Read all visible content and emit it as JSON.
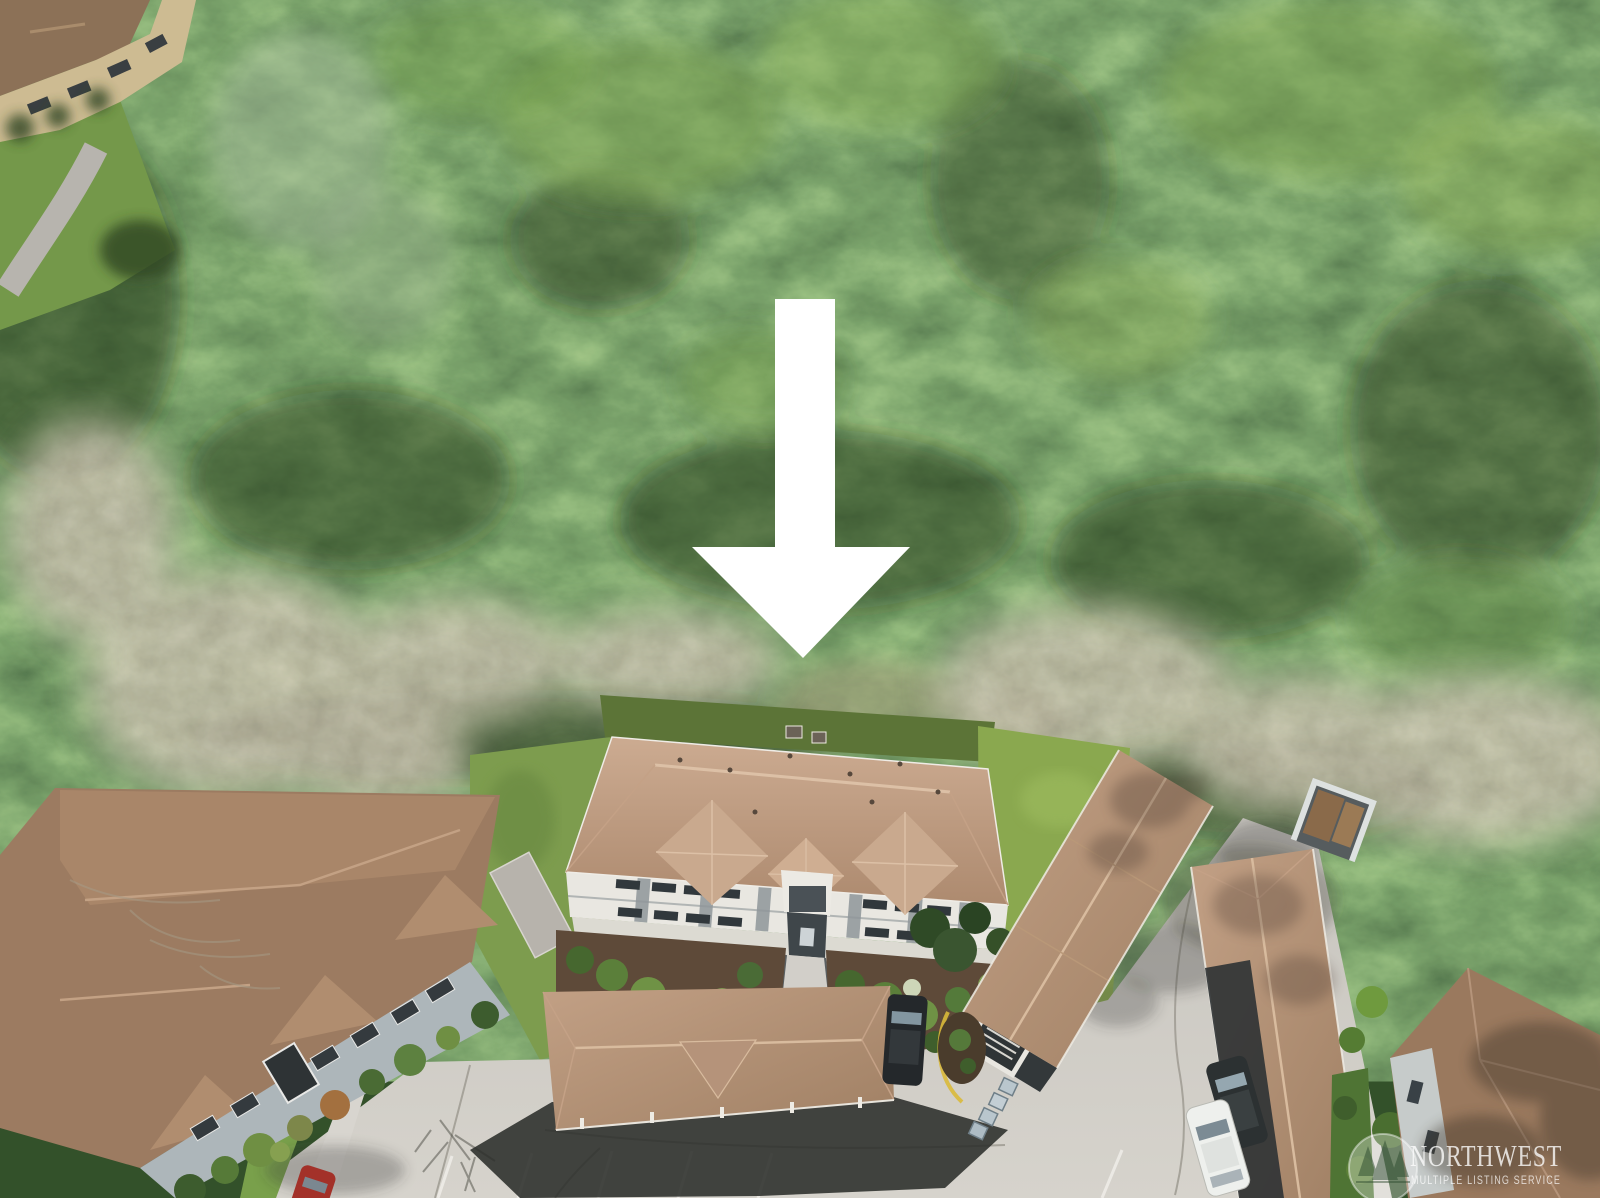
{
  "image": {
    "kind": "aerial-drone-photo",
    "subject": "three-story condominium building in evergreen forest with carports and parking"
  },
  "marker": {
    "name": "down-arrow",
    "color": "#ffffff"
  },
  "watermark": {
    "line1": "NORTHWEST",
    "line2": "MULTIPLE LISTING SERVICE",
    "logo": "nwmls-tree-circle-logo",
    "color": "#ffffff"
  },
  "scene_elements": [
    "evergreen-forest",
    "bare-deciduous-band",
    "top-left-condo-building",
    "curved-road",
    "left-condo-complex",
    "main-condo-building",
    "entry-walkway",
    "landscaped-beds",
    "center-carport",
    "carport-a",
    "carport-b",
    "driveway",
    "parking-lot",
    "dumpster-enclosure",
    "recycling-bins",
    "black-suv",
    "dark-suv",
    "white-car",
    "red-car",
    "bottom-right-building",
    "down-arrow-marker",
    "nwmls-watermark"
  ],
  "palette": {
    "forest_dark": "#23391d",
    "forest_mid": "#3f6130",
    "forest_light": "#7ca24e",
    "bare_trees": "#9a9080",
    "roof_tan": "#c0a189",
    "roof_brown": "#9c7b61",
    "wall_white": "#e9e7e1",
    "wall_gray": "#adb6ba",
    "concrete": "#cdcac4",
    "lawn": "#7fa04c",
    "shadow": "#2b2d2a",
    "arrow": "#ffffff",
    "car_red": "#a33129",
    "car_white": "#eef0ed",
    "suv_dark": "#2c3132",
    "bins_blue": "#b9c6cd",
    "curb_yellow": "#d9b93a"
  }
}
